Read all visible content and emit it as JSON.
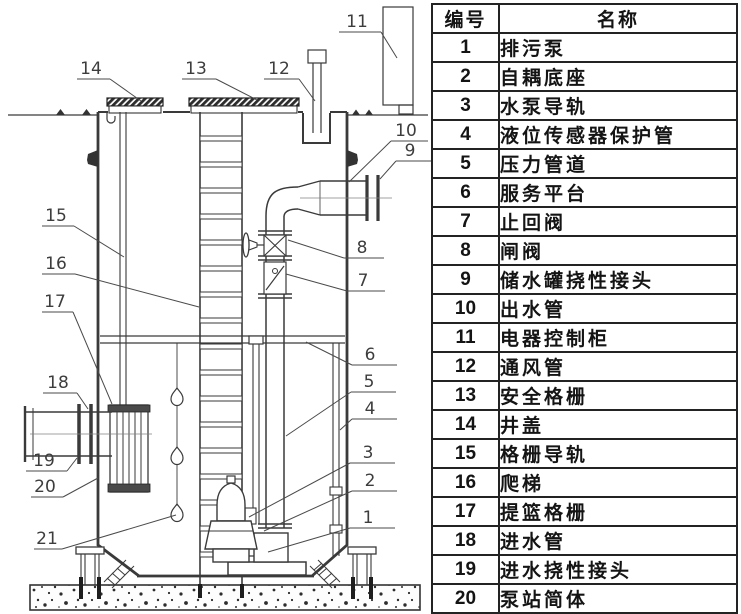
{
  "table": {
    "header": {
      "id": "编号",
      "name": "名称"
    },
    "rows": [
      {
        "id": "1",
        "name": "排污泵"
      },
      {
        "id": "2",
        "name": "自耦底座"
      },
      {
        "id": "3",
        "name": "水泵导轨"
      },
      {
        "id": "4",
        "name": "液位传感器保护管"
      },
      {
        "id": "5",
        "name": "压力管道"
      },
      {
        "id": "6",
        "name": "服务平台"
      },
      {
        "id": "7",
        "name": "止回阀"
      },
      {
        "id": "8",
        "name": "闸阀"
      },
      {
        "id": "9",
        "name": "储水罐挠性接头"
      },
      {
        "id": "10",
        "name": "出水管"
      },
      {
        "id": "11",
        "name": "电器控制柜"
      },
      {
        "id": "12",
        "name": "通风管"
      },
      {
        "id": "13",
        "name": "安全格栅"
      },
      {
        "id": "14",
        "name": "井盖"
      },
      {
        "id": "15",
        "name": "格栅导轨"
      },
      {
        "id": "16",
        "name": "爬梯"
      },
      {
        "id": "17",
        "name": "提篮格栅"
      },
      {
        "id": "18",
        "name": "进水管"
      },
      {
        "id": "19",
        "name": "进水挠性接头"
      },
      {
        "id": "20",
        "name": "泵站简体"
      },
      {
        "id": "21",
        "name": "冗余浮球"
      }
    ]
  },
  "diagram": {
    "callouts": [
      {
        "label": "1",
        "tx": 368,
        "u": [
          350,
          395,
          528
        ],
        "s": [
          350,
          528
        ],
        "e": [
          268,
          552
        ]
      },
      {
        "label": "2",
        "tx": 370,
        "u": [
          352,
          397,
          491
        ],
        "s": [
          352,
          491
        ],
        "e": [
          264,
          531
        ]
      },
      {
        "label": "3",
        "tx": 368,
        "u": [
          350,
          395,
          463
        ],
        "s": [
          350,
          463
        ],
        "e": [
          249,
          517
        ]
      },
      {
        "label": "4",
        "tx": 370,
        "u": [
          352,
          397,
          419
        ],
        "s": [
          352,
          419
        ],
        "e": [
          340,
          430
        ]
      },
      {
        "label": "5",
        "tx": 369,
        "u": [
          351,
          396,
          392
        ],
        "s": [
          351,
          392
        ],
        "e": [
          286,
          436
        ]
      },
      {
        "label": "6",
        "tx": 370,
        "u": [
          352,
          397,
          365
        ],
        "s": [
          352,
          365
        ],
        "e": [
          306,
          342
        ]
      },
      {
        "label": "7",
        "tx": 363,
        "u": [
          347,
          385,
          291
        ],
        "s": [
          347,
          291
        ],
        "e": [
          286,
          274
        ]
      },
      {
        "label": "8",
        "tx": 362,
        "u": [
          344,
          384,
          258
        ],
        "s": [
          344,
          258
        ],
        "e": [
          288,
          240
        ]
      },
      {
        "label": "9",
        "tx": 410,
        "u": [
          396,
          432,
          161
        ],
        "s": [
          396,
          161
        ],
        "e": [
          380,
          179
        ]
      },
      {
        "label": "10",
        "tx": 406,
        "u": [
          391,
          428,
          141
        ],
        "s": [
          391,
          141
        ],
        "e": [
          349,
          182
        ]
      },
      {
        "label": "11",
        "tx": 357,
        "u": [
          339,
          381,
          32
        ],
        "s": [
          381,
          32
        ],
        "e": [
          397,
          58
        ]
      },
      {
        "label": "12",
        "tx": 279,
        "u": [
          264,
          299,
          79
        ],
        "s": [
          299,
          79
        ],
        "e": [
          315,
          101
        ]
      },
      {
        "label": "13",
        "tx": 196,
        "u": [
          182,
          216,
          79
        ],
        "s": [
          216,
          79
        ],
        "e": [
          257,
          100
        ]
      },
      {
        "label": "14",
        "tx": 91,
        "u": [
          77,
          110,
          79
        ],
        "s": [
          110,
          79
        ],
        "e": [
          141,
          101
        ]
      },
      {
        "label": "15",
        "tx": 56,
        "u": [
          42,
          74,
          226
        ],
        "s": [
          74,
          226
        ],
        "e": [
          124,
          257
        ]
      },
      {
        "label": "16",
        "tx": 56,
        "u": [
          42,
          75,
          274
        ],
        "s": [
          75,
          274
        ],
        "e": [
          199,
          307
        ]
      },
      {
        "label": "17",
        "tx": 55,
        "u": [
          42,
          73,
          312
        ],
        "s": [
          73,
          312
        ],
        "e": [
          112,
          404
        ]
      },
      {
        "label": "18",
        "tx": 58,
        "u": [
          43,
          77,
          393
        ],
        "s": [
          77,
          393
        ],
        "e": [
          88,
          409
        ]
      },
      {
        "label": "19",
        "tx": 44,
        "u": [
          26,
          67,
          471
        ],
        "s": [
          67,
          471
        ],
        "e": [
          77,
          458
        ]
      },
      {
        "label": "20",
        "tx": 45,
        "u": [
          31,
          63,
          497
        ],
        "s": [
          63,
          497
        ],
        "e": [
          98,
          478
        ]
      },
      {
        "label": "21",
        "tx": 47,
        "u": [
          34,
          62,
          549
        ],
        "s": [
          62,
          549
        ],
        "e": [
          176,
          515
        ]
      }
    ]
  },
  "colors": {
    "line": "#3a3a3a",
    "label": "#3d3d3d",
    "table_border": "#232323",
    "text": "#141414"
  }
}
